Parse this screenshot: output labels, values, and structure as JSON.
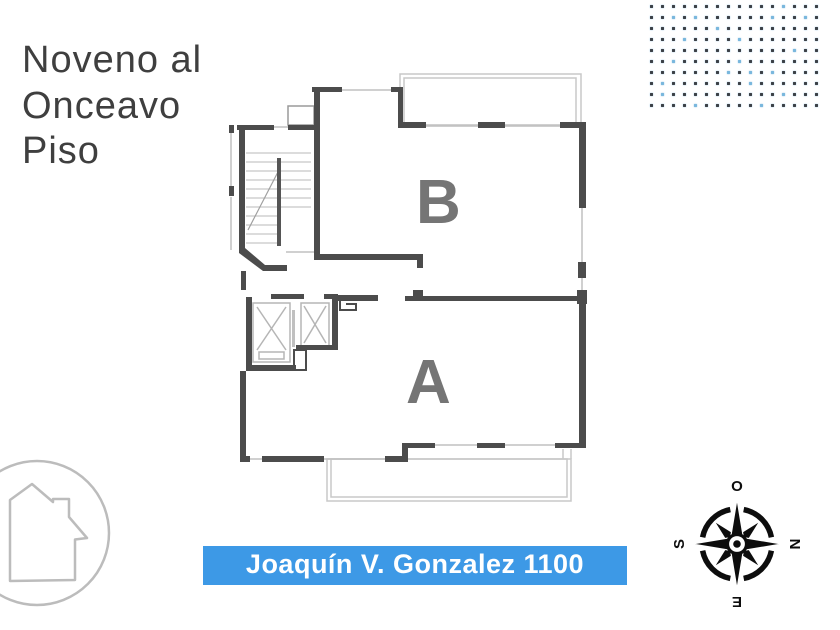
{
  "title": {
    "lines": [
      "Noveno al",
      "Onceavo",
      "Piso"
    ]
  },
  "floor_plan": {
    "unit_labels": {
      "b": "B",
      "a": "A"
    },
    "label_color": "#757575",
    "wall_color": "#4c4c4c",
    "window_line_color": "#c0c0c0",
    "balcony_line_color": "#c8c8c8"
  },
  "address_bar": {
    "text": "Joaquín V. Gonzalez 1100",
    "background": "#3d99e6",
    "text_color": "#ffffff"
  },
  "compass": {
    "top": "O",
    "right": "N",
    "bottom": "E",
    "left": "S",
    "color": "#0d0d0d"
  },
  "dot_pattern": {
    "rows": 10,
    "cols": 16,
    "dot_color": "#3c4147",
    "accent_dot_color": "#79b7dd",
    "accent_positions": [
      [
        0,
        12
      ],
      [
        1,
        2
      ],
      [
        1,
        4
      ],
      [
        1,
        11
      ],
      [
        1,
        14
      ],
      [
        2,
        6
      ],
      [
        3,
        3
      ],
      [
        3,
        8
      ],
      [
        4,
        13
      ],
      [
        5,
        2
      ],
      [
        5,
        8
      ],
      [
        6,
        7
      ],
      [
        6,
        9
      ],
      [
        6,
        11
      ],
      [
        7,
        1
      ],
      [
        7,
        9
      ],
      [
        8,
        1
      ],
      [
        8,
        12
      ],
      [
        9,
        4
      ],
      [
        9,
        10
      ]
    ]
  },
  "house_icon": {
    "color": "#bcbcbc"
  }
}
